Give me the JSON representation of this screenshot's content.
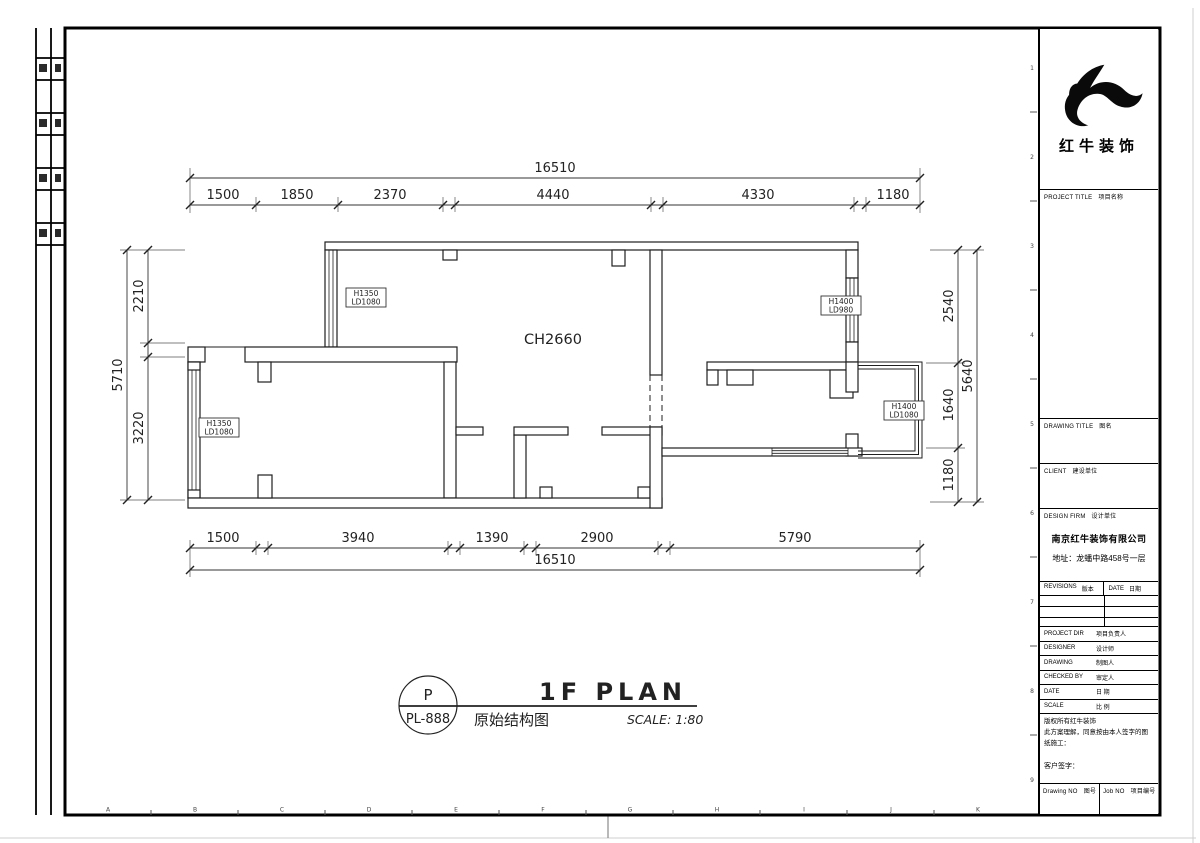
{
  "brand": {
    "name": "红牛装饰"
  },
  "plan": {
    "title": "1F PLAN",
    "subtitle": "原始结构图",
    "scale_label": "SCALE: 1:80",
    "tag_letter": "P",
    "tag_code": "PL-888",
    "ceiling": "CH2660",
    "dims": {
      "top": {
        "total": "16510",
        "segments": [
          "1500",
          "1850",
          "2370",
          "4440",
          "4330",
          "1180"
        ]
      },
      "bottom": {
        "total": "16510",
        "segments": [
          "1500",
          "3940",
          "1390",
          "2900",
          "5790"
        ]
      },
      "left": {
        "total": "5710",
        "segments": [
          "2210",
          "3220"
        ]
      },
      "right": {
        "total": "5640",
        "segments": [
          "2540",
          "1640",
          "1180"
        ]
      }
    },
    "window_labels": [
      {
        "l1": "H1350",
        "l2": "LD1080"
      },
      {
        "l1": "H1350",
        "l2": "LD1080"
      },
      {
        "l1": "H1400",
        "l2": "LD980"
      },
      {
        "l1": "H1400",
        "l2": "LD1080"
      }
    ],
    "grid_letters": [
      "A",
      "B",
      "C",
      "D",
      "E",
      "F",
      "G",
      "H",
      "I",
      "J",
      "K"
    ],
    "grid_numbers": [
      "1",
      "2",
      "3",
      "4",
      "5",
      "6",
      "7",
      "8",
      "9"
    ]
  },
  "titleblock": {
    "project_title": {
      "en": "PROJECT TITLE",
      "zh": "项目名称"
    },
    "drawing_title": {
      "en": "DRAWING TITLE",
      "zh": "图名"
    },
    "client": {
      "en": "CLIENT",
      "zh": "建设单位"
    },
    "design_firm": {
      "en": "DESIGN FIRM",
      "zh": "设计单位"
    },
    "firm_name": "南京红牛装饰有限公司",
    "firm_address": "地址：龙蟠中路458号一层",
    "revisions": {
      "en": "REVISIONS",
      "zh": "版本"
    },
    "date_col": {
      "en": "DATE",
      "zh": "日期"
    },
    "project_dir": {
      "en": "PROJECT DIR",
      "zh": "项目负责人"
    },
    "designer": {
      "en": "DESIGNER",
      "zh": "设计师"
    },
    "drawing": {
      "en": "DRAWING",
      "zh": "制图人"
    },
    "checked_by": {
      "en": "CHECKED BY",
      "zh": "审定人"
    },
    "date_row": {
      "en": "DATE",
      "zh": "日 期"
    },
    "scale_row": {
      "en": "SCALE",
      "zh": "比 例"
    },
    "note1": "版权所有红牛装饰",
    "note2": "此方案理解，同意按由本人签字的图纸施工：",
    "client_sign": "客户签字：",
    "drawing_no": {
      "en": "Drawing NO",
      "zh": "图号"
    },
    "job_no": {
      "en": "Job NO",
      "zh": "项目编号"
    }
  }
}
